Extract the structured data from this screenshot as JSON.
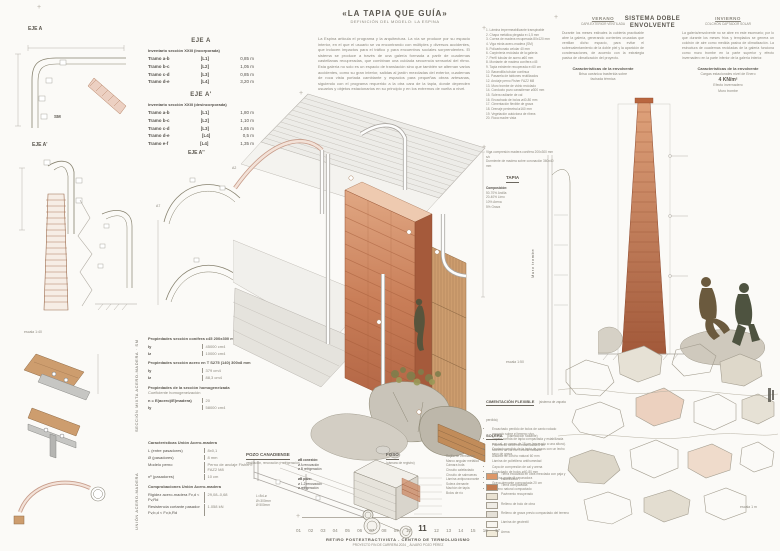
{
  "sheet": {
    "title": "«LA TAPIA QUE GUÍA»",
    "subtitle": "DEFINICIÓN DEL MODELO: LA ESPINA",
    "intro": "La Espina articula el programa y la arquitectura. La vía se produce por su espacio interior, en el que el usuario se va encontrando con múltiples y diversos accidentes, que inducen impactos para el tráfico y para encuentros sociales sorprendentes. El sistema se produce a través de una galería formada a partir de cuadernas castellanas recuperadas, que combinan una cuidada secuencia sensorial del ritmo. Esta galería no solo es un espacio de translación sino que también se alternan varios accidentes, como su gran interior, salidas al jardín mezcladas del exterior, cuadernas de roca vista portada cambiante y espacios para pequeñas obras artesanas, siguiendo con el programa requerido a la otra cara de la tapia, donde dependen usuarios y objetos estacionarios en su principio y en los extremos de vuelta a nivel."
  },
  "axes": {
    "eje_a_label": "EJE A",
    "sm_label": "SM",
    "eje_a1_label": "EJE A'",
    "eje_a2_label": "EJE A''",
    "a2": "A2",
    "a7": "A7",
    "af": "AF",
    "escala_left": "escala 1:40",
    "escala_mid": "escala 1:50",
    "escala_right": "escala 1 m"
  },
  "tables": {
    "eje_a": {
      "title": "EJE A",
      "subtitle": "Inventario sección XXIII (incorporada)",
      "rows": [
        {
          "name": "Tramo a-b",
          "ref": "[L1]",
          "val": "0,85 m"
        },
        {
          "name": "Tramo b-c",
          "ref": "[L2]",
          "val": "1,05 m"
        },
        {
          "name": "Tramo c-d",
          "ref": "[L3]",
          "val": "0,85 m"
        },
        {
          "name": "Tramo d-e",
          "ref": "[L4]",
          "val": "3,20 m"
        }
      ]
    },
    "eje_a1": {
      "title": "EJE A'",
      "subtitle": "Inventario sección XXIII (desincorporada)",
      "rows": [
        {
          "name": "Tramo a-b",
          "ref": "[L1]",
          "val": "1,80 m"
        },
        {
          "name": "Tramo b-c",
          "ref": "[L2]",
          "val": "1,10 m"
        },
        {
          "name": "Tramo c-d",
          "ref": "[L3]",
          "val": "1,65 m"
        },
        {
          "name": "Tramo d-e",
          "ref": "[L4]",
          "val": "0,5 m"
        },
        {
          "name": "Tramo e-f",
          "ref": "[L4]",
          "val": "1,35 m"
        }
      ]
    }
  },
  "properties": {
    "p1_title": "Propiedades sección conífera c45 200x300 mm s2:",
    "p1_rows": [
      {
        "k": "Iy",
        "v": "45000 cm4"
      },
      {
        "k": "Iz",
        "v": "10000 cm4"
      }
    ],
    "p2_title": "Propiedades sección acero en T S275 (140) 300x8 mm",
    "p2_rows": [
      {
        "k": "Iy",
        "v": "379 cm4"
      },
      {
        "k": "Iz",
        "v": "88,3 cm4"
      }
    ],
    "p3_title": "Propiedades de la sección homogeneizada",
    "p3_note": "Coeficiente homogeneización",
    "p3_rows": [
      {
        "k": "n = E(acero)/E(madera)",
        "v": "20"
      },
      {
        "k": "Iy",
        "v": "58000 cm4"
      }
    ],
    "side_label": "SECCIÓN MIXTA ACERO-MADERA · SM"
  },
  "union": {
    "title": "Características Unión Acero-madera",
    "rows": [
      {
        "k": "L (entre pasadores)",
        "v": "8x0,1"
      },
      {
        "k": "Ø (pasadores)",
        "v": "8 mm"
      },
      {
        "k": "Modelo perno",
        "v": "Perno de anclaje Fisher® FAZ2 M8"
      },
      {
        "k": "nº (pasadores)",
        "v": "10 cm"
      }
    ],
    "comp_title": "Comprobaciones Unión Acero-madera",
    "comp_rows": [
      {
        "k": "Rigidez acero-madera  Fv,d < Fv,Rd",
        "v": "29,08–0,68"
      },
      {
        "k": "Resistencia cortante pasador  Fv,b,d < Fv,b,Rd",
        "v": "1.058 kN"
      }
    ],
    "side_label": "UNIÓN ACERO-MADERA"
  },
  "legend_numbered": {
    "items": [
      "1. Lámina impermeabilizante transpirable",
      "2. Chapa metálica plegada e=1,5 mm",
      "3. Correa de madera recuperada 80x120 mm",
      "4. Viga mixta acero-madera (SM)",
      "5. Policarbonato celular 40 mm",
      "6. Carpintería reciclada de la galería",
      "7. Perfil tubular de acero ø60 mm",
      "8. Montante de madera conífera c45",
      "9. Tapia existente recuperada e=60 cm",
      "10. Barandilla tubular continua",
      "11. Pasarela de tablones reutilizados",
      "12. Anclaje perno Fisher FAZ2 M8",
      "13. Muro trombe de vidrio reciclado",
      "14. Conducto pozo canadiense ø300 mm",
      "15. Solera radiante de cal",
      "16. Encachado de bolos ø40-80 mm",
      "17. Cimentación flexible de grava",
      "18. Drenaje perimetral ø160 mm",
      "19. Vegetación autóctona de ribera",
      "20. Roca madre vista"
    ]
  },
  "tapia": {
    "note1": "Viga compresión madera conífera 200x300 mm s/c",
    "note2": "Durmiente de madera sobre coronación 360x40 mm",
    "title": "TAPIA",
    "comp_label": "Composición:",
    "items": [
      "50-70% Arcilla",
      "20-40% Limo",
      "10% Arena",
      "5% Grava"
    ],
    "trombe_label": "Muro trombe"
  },
  "verano": {
    "title": "VERANO",
    "subtitle": "CAPA EXTERIOR VENTILADA",
    "body": "Durante los meses estivales la cubierta practicable abre la galería, generando corrientes cruzadas que ventilan dicho espacio, para evitar el sobrecalentamiento de la doble piel y la aparición de condensaciones, de acuerdo con la estrategia pasiva de climatización del proyecto.",
    "char_title": "Características de la envolvente",
    "char_lines": [
      "Brisa oceánica trasferida sobre",
      "fachada térmica"
    ]
  },
  "sistema_title": "SISTEMA DOBLE ENVOLVENTE",
  "invierno": {
    "title": "INVIERNO",
    "subtitle": "COLCHÓN CAPTADOR SOLAR",
    "body": "La galería/envolvente no se abre en este escenario; por lo que durante los meses fríos y templados se genera un colchón de aire como medida pasiva de climatización. La estructura de cuadernas recicladas de la galería funciona como muro trombe en la parte superior y efecto invernadero en la parte inferior de la galería interior.",
    "char_title": "Características de la envolvente",
    "char_line1": "Cargas estacionales nivel de Enero",
    "char_bold": "4 KN/m²",
    "char_lines2": [
      "Efecto invernadero",
      "Muro trombe"
    ]
  },
  "cimentacion": {
    "title": "CIMENTACIÓN FLEXIBLE",
    "subtitle": "(sistema de zapata perdida)",
    "items": [
      "Encachado perdido de bolos de canto rodado apoyado sobre el terreno vivo.",
      "Zapata corrida de tapia compactada y estabilizada con cal, en capas de 15 cm (enrasado a una altura).",
      "Contacto perdido de la tapia de pozos con un lecho seco de grava."
    ]
  },
  "solera": {
    "title": "SOLERA",
    "subtitle": "(calefacción radiante)",
    "items": [
      "Pavimento de tierra estabilizada 8 cm",
      "Mortero de cal con circuito radiante",
      "Aislante de corcho natural 60 mm",
      "Lámina de polietileno antihumedad",
      "Capa de compresión de cal y arena",
      "Encachado de bolos ø40-80 mm",
      "Lámina geotextil separadora",
      "Grava drenante compactada 20 cm",
      "Terreno natural compactado"
    ]
  },
  "materials": {
    "items": [
      {
        "color": "#dd9768",
        "label": "Tierra excavada en obra mezclada con paja y estabilizada"
      },
      {
        "color": "#c27b50",
        "label": "Tierra compactada"
      },
      {
        "color": "#e9e2d2",
        "label": "Pavimento recuperado"
      },
      {
        "color": "#efece5",
        "label": "Relleno de bolo de obra"
      },
      {
        "color": "#e4e0d7",
        "label": "Relleno de grava previo compactado del terreno"
      },
      {
        "color": "#f7f5f0",
        "label": "Lámina de geotextil"
      },
      {
        "color": "#f0ead9",
        "label": "Arena"
      }
    ]
  },
  "pozo": {
    "title": "POZO CANADIENSE",
    "subtitle": "ventilación, renovación y refrigeración",
    "g1_title": "øB conexión:",
    "g1_lines": [
      "ø A renovación",
      "ø B refrigeración"
    ],
    "g2_title": "øB pozo:",
    "g2_lines": [
      "ø 1-2 renovación",
      "ø refrigeración"
    ],
    "g3_lines": [
      "L=8xLø",
      "Ø=300mm",
      "Ø 500mm"
    ]
  },
  "foso": {
    "title": "FOSO",
    "subtitle": "(cámara de registro)",
    "labels": [
      "Rejilla de ventilación",
      "Marco angular metálico",
      "Cámara bufa",
      "Circuito calefactado",
      "Circuito de salmueras",
      "Lámina antipunzonante",
      "Solera drenante",
      "Machón de tapia",
      "Bolos de río"
    ]
  },
  "footer": {
    "scale_numbers": [
      "01",
      "02",
      "03",
      "04",
      "05",
      "06",
      "07",
      "08",
      "09",
      "10",
      "11",
      "12",
      "13",
      "14",
      "15",
      "16",
      "17"
    ],
    "scale_current": "11",
    "caption": "RETIRO POSTEXTRACTIVISTA - CENTRO DE TERMOLUDISMO",
    "subcaption": "PROYECTO FIN DE CARRERA 2024 _ ÁLVARO POZO PÉREZ"
  },
  "colors": {
    "terracotta": "#c2714e",
    "terracotta_light": "#e2a585",
    "wood": "#cd9d6e",
    "olive": "#7f7e4c",
    "stone": "#bdb7aa",
    "ink": "#54504a"
  }
}
